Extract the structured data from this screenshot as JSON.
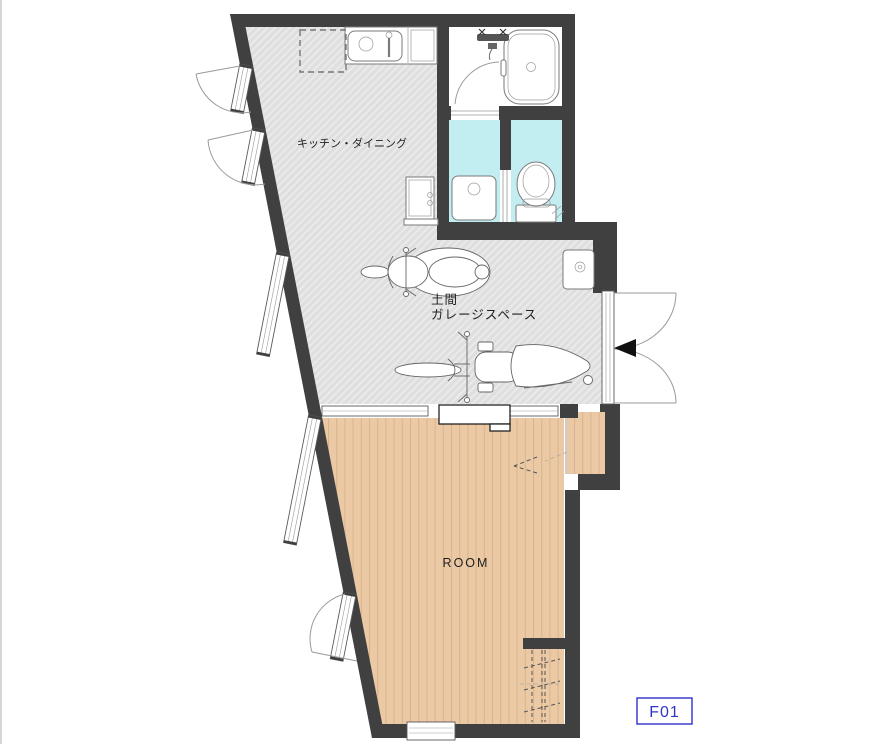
{
  "page": {
    "background": "#ffffff"
  },
  "floorplan": {
    "labels": {
      "kitchen_dining": "キッチン・ダイニング",
      "doma": "土間",
      "garage_space": "ガレージスペース",
      "room": "ROOM"
    },
    "unit_tag": {
      "text": "F01"
    },
    "colors": {
      "wall": "#404040",
      "hatched_floor": "#dfdfdf",
      "hatch_line": "#ececec",
      "wood_floor": "#ebc9a4",
      "wood_plank_line": "#d9b48e",
      "wet_room": "#c2eef2",
      "fixture_outline": "#7a7a7a",
      "door_arc": "#9a9a9a",
      "text": "#1f1f1f",
      "unit_label_text": "#2f35c5",
      "unit_label_border": "#3b3fd0"
    },
    "fixtures": {
      "bathtub": "bathtub-icon",
      "shower_mixer": "shower-mixer-icon",
      "kitchen_sink": "kitchen-sink-icon",
      "refrigerator_space": "refrigerator-dashed-outline",
      "washing_machine_pan": "washing-machine-pan-icon",
      "washbasin": "washbasin-icon",
      "toilet": "toilet-icon",
      "utility_sink": "utility-sink-icon",
      "scooter": "scooter-top-view-icon",
      "motorcycle": "motorcycle-top-view-icon",
      "entrance_arrow": "entrance-arrow-icon",
      "ladder": "ladder-dashed-icon"
    }
  }
}
